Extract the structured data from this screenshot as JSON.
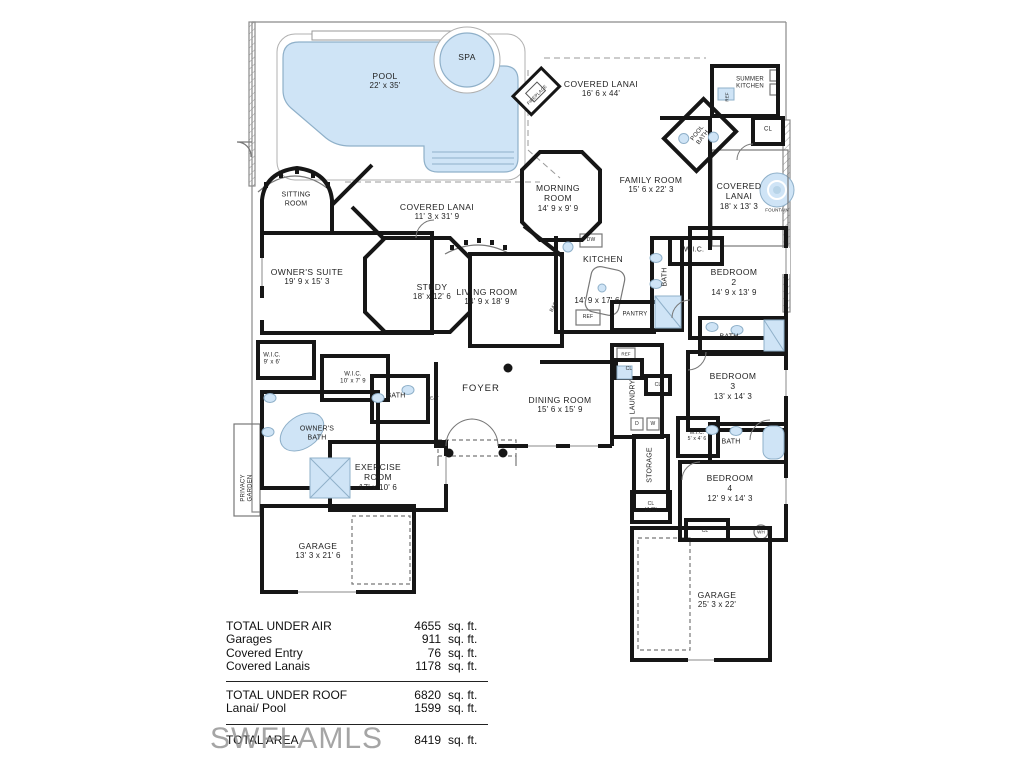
{
  "plan": {
    "pool": {
      "name": "POOL",
      "dims": "22' x 35'"
    },
    "spa": {
      "name": "SPA"
    },
    "sitting": {
      "name": "SITTING\nROOM"
    },
    "lanai_top": {
      "name": "COVERED LANAI",
      "dims": "16' 6 x 44'"
    },
    "fireplace": {
      "name": "FIREPLACE"
    },
    "summer_kitchen": {
      "name": "SUMMER\nKITCHEN"
    },
    "ref_summer": {
      "name": "REF"
    },
    "cl_top": {
      "name": "CL"
    },
    "pool_bath": {
      "name": "POOL\nBATH"
    },
    "lanai_right": {
      "name": "COVERED\nLANAI",
      "dims": "18' x 13' 3"
    },
    "fountain": {
      "name": "FOUNTAIN"
    },
    "morning": {
      "name": "MORNING\nROOM",
      "dims": "14' 9 x 9' 9"
    },
    "family": {
      "name": "FAMILY ROOM",
      "dims": "15' 6 x 22' 3"
    },
    "lanai_left": {
      "name": "COVERED LANAI",
      "dims": "11' 3 x 31' 9"
    },
    "owners_suite": {
      "name": "OWNER'S SUITE",
      "dims": "19' 9 x 15' 3"
    },
    "study": {
      "name": "STUDY",
      "dims": "18' x 12' 6"
    },
    "living": {
      "name": "LIVING ROOM",
      "dims": "14' 9 x 18' 9"
    },
    "kitchen": {
      "name": "KITCHEN",
      "dims": "14' 9 x 17' 6"
    },
    "dw": {
      "name": "DW"
    },
    "bar": {
      "name": "BAR"
    },
    "ref_kitchen": {
      "name": "REF"
    },
    "pantry": {
      "name": "PANTRY"
    },
    "bath_bed2_upper": {
      "name": "BATH"
    },
    "wic_bed2": {
      "name": "W.I.C."
    },
    "bed2": {
      "name": "BEDROOM\n2",
      "dims": "14' 9 x 13' 9"
    },
    "bath_bed2_lower": {
      "name": "BATH"
    },
    "wic_owner_small": {
      "name": "W.I.C.\n9' x 6'"
    },
    "wic_owner_large": {
      "name": "W.I.C.\n10' x 7' 9"
    },
    "bath_hall": {
      "name": "BATH"
    },
    "seat": {
      "name": "SEAT"
    },
    "foyer": {
      "name": "FOYER"
    },
    "dining": {
      "name": "DINING ROOM",
      "dims": "15' 6 x 15' 9"
    },
    "ref_laundry": {
      "name": "REF"
    },
    "cl_laundry_1": {
      "name": "CL"
    },
    "cl_laundry_2": {
      "name": "CL"
    },
    "laundry": {
      "name": "LAUNDRY"
    },
    "dryer": {
      "name": "D"
    },
    "washer": {
      "name": "W"
    },
    "storage": {
      "name": "STORAGE"
    },
    "cl_ac": {
      "name": "CL\n(A/C)"
    },
    "bed3": {
      "name": "BEDROOM\n3",
      "dims": "13' x 14' 3"
    },
    "wic_bed3": {
      "name": "W.I.C.\n5' x 4' 6"
    },
    "bath_bed3": {
      "name": "BATH"
    },
    "bed4": {
      "name": "BEDROOM\n4",
      "dims": "12' 9 x 14' 3"
    },
    "cl_bed4": {
      "name": "CL"
    },
    "wh": {
      "name": "WH"
    },
    "garage_right": {
      "name": "GARAGE",
      "dims": "25' 3 x 22'"
    },
    "owners_bath": {
      "name": "OWNER'S\nBATH"
    },
    "privacy_garden": {
      "name": "PRIVACY\nGARDEN"
    },
    "exercise": {
      "name": "EXERCISE\nROOM",
      "dims": "17' x 10' 6"
    },
    "garage_left": {
      "name": "GARAGE",
      "dims": "13' 3 x 21' 6"
    }
  },
  "summary": {
    "unit": "sq. ft.",
    "rows": [
      {
        "label": "TOTAL UNDER AIR",
        "value": "4655"
      },
      {
        "label": "Garages",
        "value": "911"
      },
      {
        "label": "Covered Entry",
        "value": "76"
      },
      {
        "label": "Covered Lanais",
        "value": "1178"
      }
    ],
    "rows2": [
      {
        "label": "TOTAL UNDER ROOF",
        "value": "6820"
      },
      {
        "label": "Lanai/ Pool",
        "value": "1599"
      }
    ],
    "total": {
      "label": "TOTAL AREA",
      "value": "8419"
    }
  },
  "watermark": "SWFLAMLS",
  "colors": {
    "wall": "#161616",
    "water": "#cfe4f6",
    "water_edge": "#8fb0c9",
    "watermark": "#8f8f8f"
  }
}
